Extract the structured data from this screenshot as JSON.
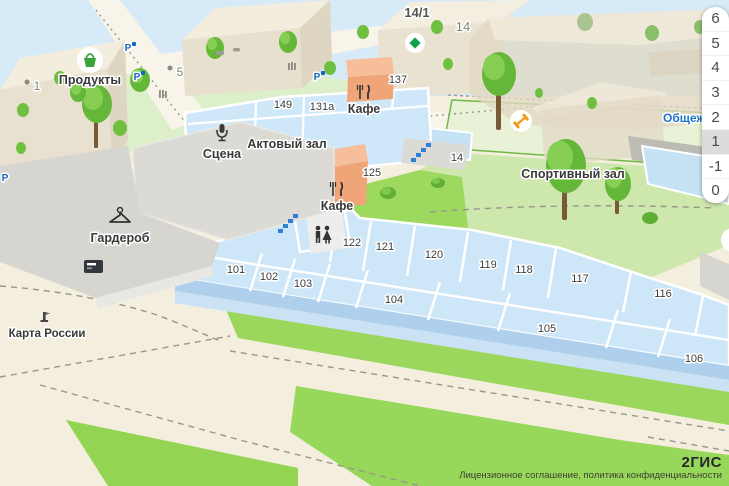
{
  "map": {
    "poi_labels": {
      "groceries": "Продукты",
      "stage": "Сцена",
      "assembly_hall": "Актовый зал",
      "cafe_1": "Кафе",
      "cafe_2": "Кафе",
      "cloakroom": "Гардероб",
      "sports_hall": "Спортивный зал",
      "russia_map": "Карта России",
      "dormitory": "Общежитие"
    },
    "address_labels": {
      "b1": "1",
      "b5": "5",
      "b14_1": "14/1",
      "b14": "14"
    },
    "rooms": {
      "r149": "149",
      "r131a": "131а",
      "r137": "137",
      "r125": "125",
      "r14": "14",
      "r101": "101",
      "r102": "102",
      "r103": "103",
      "r104": "104",
      "r105": "105",
      "r106": "106",
      "r116": "116",
      "r117": "117",
      "r118": "118",
      "r119": "119",
      "r120": "120",
      "r121": "121",
      "r122": "122"
    },
    "parking_symbol": "P",
    "icons": {
      "groceries_marker": "basket-icon",
      "sports_marker": "dumbbell-icon",
      "poi_marker": "green-diamond-icon",
      "stage_marker": "microphone-icon",
      "cafe_marker": "fork-knife-icon",
      "cloakroom_marker": "hanger-icon",
      "wc_marker": "wc-icon",
      "stairs_marker": "stairs-icon",
      "atm_marker": "atm-icon",
      "monument_marker": "monument-icon",
      "parking_marker": "parking-icon"
    },
    "colors": {
      "room_fill": "#cfe8f9",
      "lawn_green": "#9ed95f",
      "orange_room": "#f5b18a",
      "marker_green": "#3aa33a",
      "marker_orange": "#f59b1e",
      "stairs_blue": "#2f7fd6",
      "label_blue": "#1a73c7"
    }
  },
  "floor_selector": {
    "floors": [
      "6",
      "5",
      "4",
      "3",
      "2",
      "1",
      "-1",
      "0"
    ],
    "selected": "1"
  },
  "attribution": {
    "license_links": "Лицензионное соглашение, политика конфиденциальности",
    "logo": "2ГИС"
  }
}
